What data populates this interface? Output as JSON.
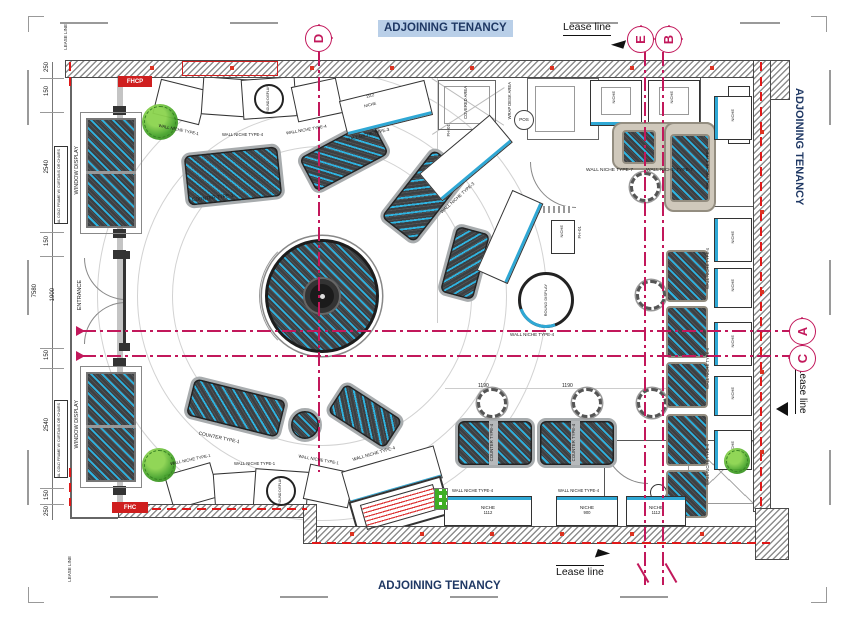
{
  "title": {
    "adjoining": "ADJOINING TENANCY"
  },
  "lease": {
    "mixed": "Lease line",
    "caps": "LEASE LINE"
  },
  "grid": {
    "d": "D",
    "e": "E",
    "b": "B",
    "a": "A",
    "c": "C"
  },
  "dims": {
    "upper": [
      "250",
      "150",
      "2540",
      "150"
    ],
    "lower": [
      "150",
      "2540",
      "150",
      "250"
    ],
    "entrance_width": "1900",
    "overall": "7580",
    "n1112": "1112",
    "n1190": "1190",
    "n900": "900"
  },
  "labels": {
    "window_display": "WINDOW DISPLAY",
    "metal_frame": "METAL COLD FRAME W/ CURTAINS OR CHAIRS",
    "entrance": "ENTRANCE",
    "fhcp": "FHCP",
    "fhc": "FHC",
    "niche": "NICHE",
    "pos": "POS",
    "fh01": "FH-01",
    "round_display": "ROUND DISPLAY",
    "covered_area": "COVERED AREA",
    "wrap_desk_area": "WRAP DESK AREA",
    "counter_type1": "COUNTER TYPE-1",
    "counter_type4": "COUNTER TYPE-4",
    "wn_type1": "WALL NICHE TYPE-1",
    "wn_type3": "WALL NICHE TYPE-3",
    "wn_type4": "WALL NICHE TYPE-4",
    "wn_type6": "WALL NICHE TYPE-6",
    "wn_type7": "WALL NICHE TYPE-7"
  }
}
